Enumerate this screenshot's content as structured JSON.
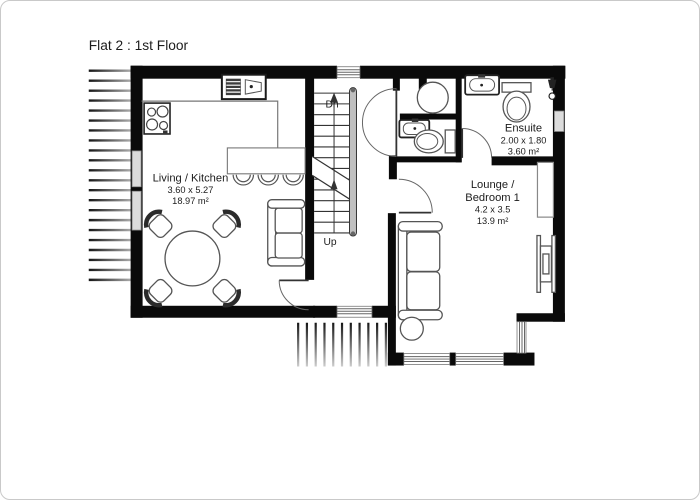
{
  "title": "Flat 2 : 1st Floor",
  "rooms": {
    "living": {
      "name": "Living / Kitchen",
      "dims": "3.60 x 5.27",
      "area": "18.97 m²"
    },
    "ensuite": {
      "name": "Ensuite",
      "dims": "2.00 x 1.80",
      "area": "3.60 m²"
    },
    "lounge": {
      "name_line1": "Lounge /",
      "name_line2": "Bedroom 1",
      "dims": "4.2 x 3.5",
      "area": "13.9 m²"
    }
  },
  "stairs": {
    "down_label": "Dn",
    "up_label": "Up"
  },
  "symbols": [
    "kitchen-sink",
    "hob",
    "bar-stool",
    "dining-table",
    "dining-chair",
    "sofa",
    "side-table",
    "wash-basin",
    "toilet",
    "shower-head",
    "round-shower",
    "radiator",
    "wardrobe",
    "staircase",
    "deck-boards",
    "window",
    "door-swing"
  ],
  "colors": {
    "wall": "#0a0a0a",
    "furniture_outline": "#555555",
    "window_fill": "#dcdcdc",
    "text": "#1c1c1c",
    "background": "#ffffff"
  }
}
